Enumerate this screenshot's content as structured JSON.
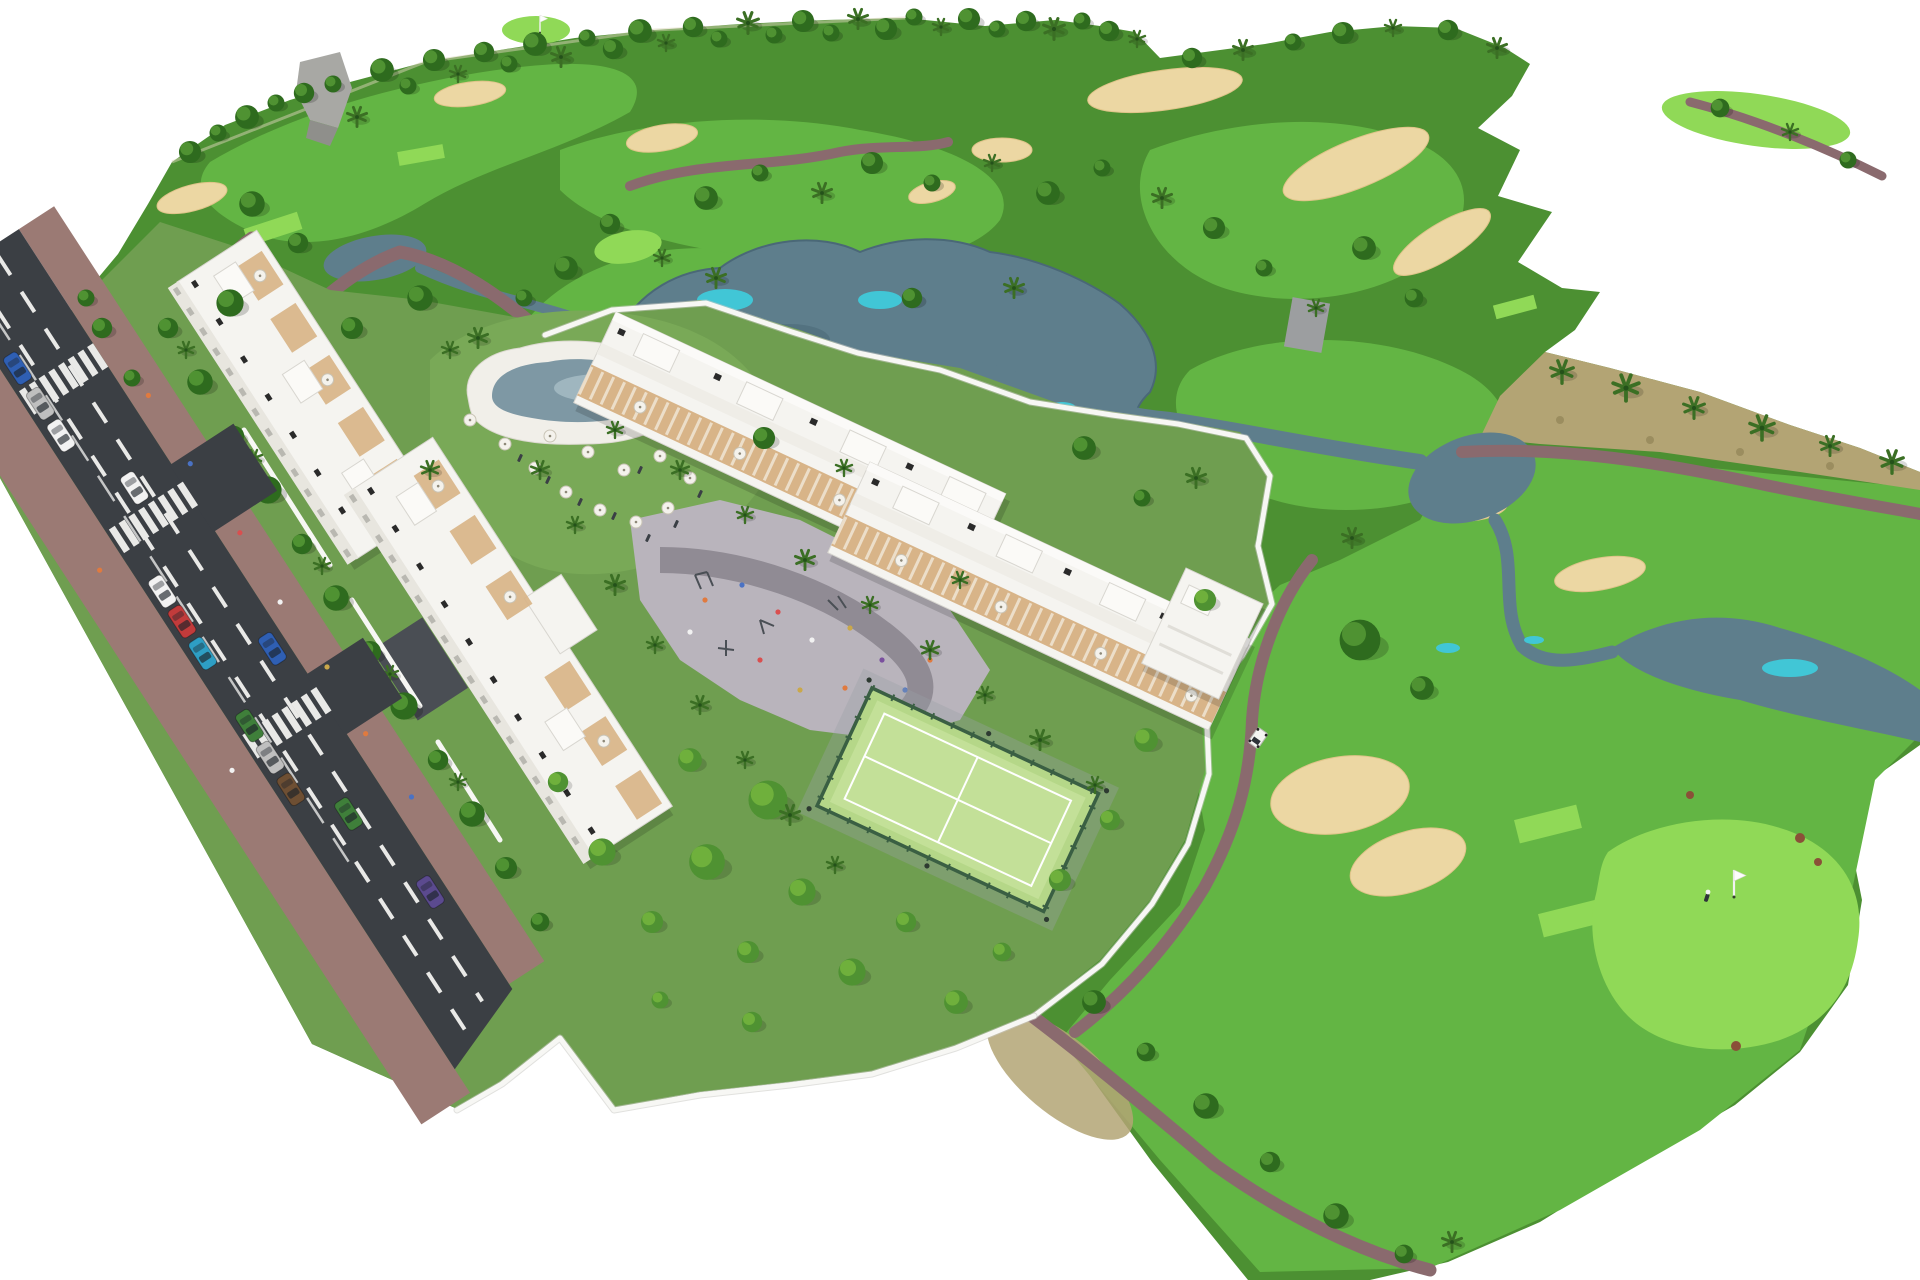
{
  "meta": {
    "description": "Aerial 3D architectural rendering of a golf-resort residential development: white apartment blocks and townhouse rows with rooftop terraces, a communal pool with umbrellas, playground plaza and fenced padel court, bordered by an avenue with parked cars and crosswalks, surrounded by a golf course with lakes, streams, sand bunkers, winding cart paths, palm trees, a putting green with flag, a golfer and a golf cart, all on a white background."
  },
  "colors": {
    "background": "#ffffff",
    "grass_rough": "#4c9032",
    "grass_fairway": "#63b544",
    "grass_light": "#90d957",
    "grass_garden": "#6f9e50",
    "scrub": "#b3a474",
    "sand": "#ecd7a3",
    "sand_shade": "#dfc489",
    "water": "#5e7e8c",
    "water_dark": "#4a6877",
    "water_teal": "#41c6d6",
    "pool": "#7e98a4",
    "path": "#8a6a6e",
    "asphalt": "#3b3f44",
    "road_mark": "#e9e9e7",
    "sidewalk": "#9b7a74",
    "drive": "#4a4e54",
    "building": "#f5f4f0",
    "building_shade": "#dddbd4",
    "accent_tan": "#d8b488",
    "wall": "#f7f7f4",
    "plaza": "#b9b4bc",
    "plaza_band": "#908b94",
    "court": "#b5d788",
    "fence": "#3a5f43",
    "tree_dark": "#2e6b1e",
    "tree_mid": "#4f9232",
    "tree_bright": "#6fb03c",
    "palm": "#3b6f24",
    "shadow": "rgba(0,0,0,0.15)"
  },
  "palette": {
    "cars": [
      "#f2f2f2",
      "#2f5fb3",
      "#c23b3b",
      "#2e9ec4",
      "#3f7f3a",
      "#6e4f33",
      "#bfbfbf",
      "#555a60",
      "#5b4a8f"
    ]
  },
  "scene": {
    "view": "isometric aerial render on white void",
    "golf": {
      "lakes": 5,
      "streams": 4,
      "bunkers": 16,
      "putting_greens": 5,
      "tee_boxes": 8,
      "flags": 2,
      "golfers": 1,
      "golf_carts": 1,
      "cart_paths": 7
    },
    "residential": {
      "apartment_blocks": 2,
      "townhouse_rows": 2,
      "roof_terraces": true,
      "communal_pool": 1,
      "pool_umbrellas": 12,
      "padel_court": 1,
      "playground_plaza": 1,
      "perimeter_wall": true,
      "private_gardens": true
    },
    "road": {
      "crosswalks": 3,
      "lane_divider_lines": 2,
      "parked_cars": 10,
      "moving_cars": 4,
      "side_street_stubs": 2,
      "sidewalks": 2,
      "pedestrians": true
    }
  }
}
